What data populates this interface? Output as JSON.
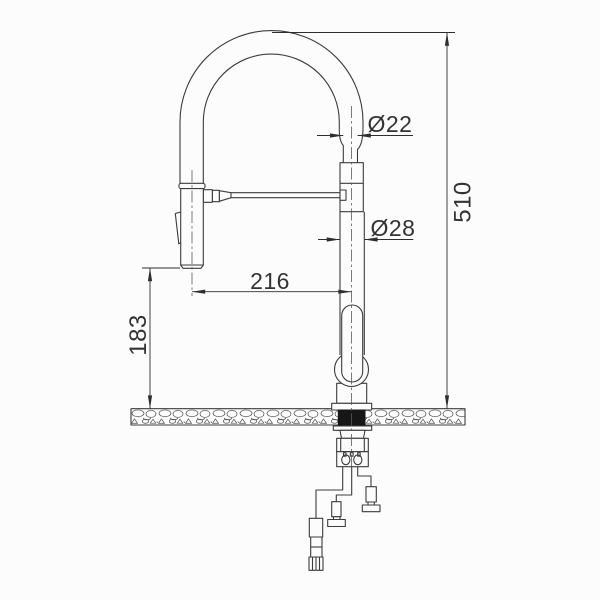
{
  "title": "Kitchen faucet installation dimension drawing",
  "drawing_type": "technical line drawing, front elevation",
  "subject": "single-lever kitchen mixer tap with flexible spring spout, side support arm and pull-out spray head, mounted through a countertop section with flexible supply hoses below",
  "units": "mm",
  "dimensions": [
    {
      "id": "spout-hose-outer-diameter",
      "label": "Ø22",
      "value": 22,
      "kind": "diameter"
    },
    {
      "id": "riser-column-outer-diameter",
      "label": "Ø28",
      "value": 28,
      "kind": "diameter"
    },
    {
      "id": "spray-axis-to-riser-axis",
      "label": "216",
      "value": 216,
      "kind": "horizontal-distance"
    },
    {
      "id": "spray-outlet-to-countertop",
      "label": "183",
      "value": 183,
      "kind": "vertical-distance"
    },
    {
      "id": "overall-height-above-countertop",
      "label": "510",
      "value": 510,
      "kind": "vertical-distance"
    }
  ],
  "colors": {
    "background": "#fcfcfc",
    "line": "#3c3c3c",
    "dimension_line": "#2e2e2e",
    "text": "#333333",
    "gasket_fill": "#161616"
  }
}
